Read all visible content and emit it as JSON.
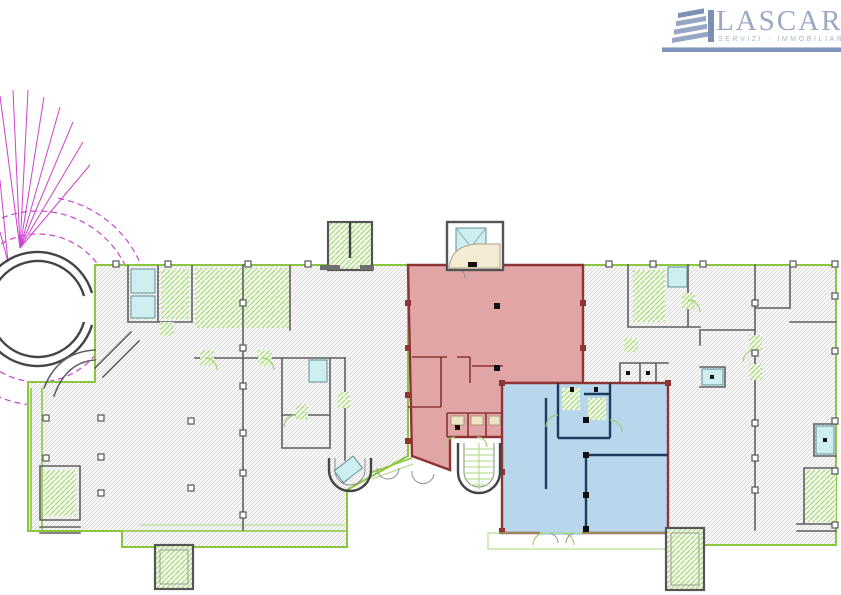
{
  "logo": {
    "title": "LASCARI",
    "subtitle": "SERVIZI · IMMOBILIARI",
    "icon": "building-icon"
  },
  "colors": {
    "logo_blue": "#9ba7c4",
    "logo_rule_blue": "#7e93bd",
    "outline_green": "#8cc63f",
    "hatch_gray": "#c8c8c8",
    "unit_red_fill": "#e2a5a5",
    "unit_red_border": "#8e3434",
    "unit_blue_fill": "#b8d6ec",
    "partition_navy": "#1d3a5f",
    "ramp_magenta": "#cc44cc",
    "elevator_cyan": "#cfeef0",
    "stair_beige": "#f3ecd2"
  }
}
